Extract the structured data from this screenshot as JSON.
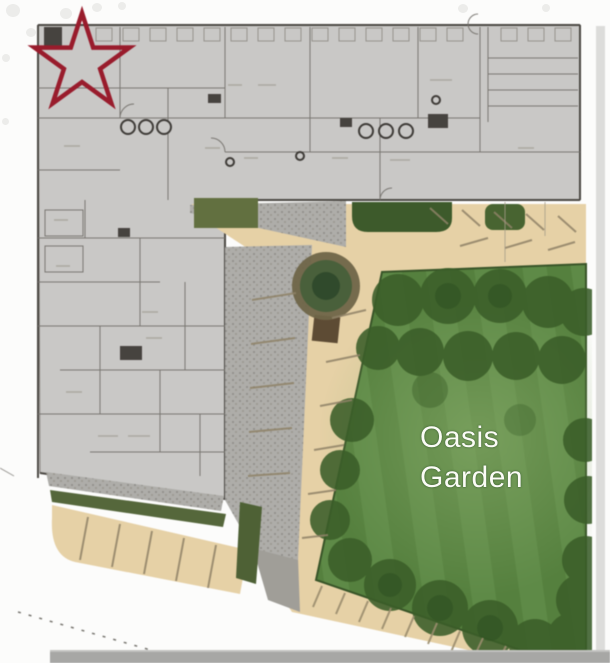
{
  "site_plan": {
    "garden_label": {
      "line1": "Oasis",
      "line2": "Garden"
    },
    "marker": {
      "shape": "five-point-star",
      "color": "#9c1b2c"
    },
    "colors": {
      "plan_gray": "#c9c8c6",
      "wall_dark": "#4b4843",
      "hardscape_tan": "#e7d1a5",
      "gravel_gray": "#aeada9",
      "lawn_green": "#54803c",
      "tree_canopy_green": "#3a5e28",
      "label_white": "#fbfcf6",
      "bottom_bar_gray": "#a7a7a5",
      "right_strip_gray": "#dcdcda"
    }
  }
}
